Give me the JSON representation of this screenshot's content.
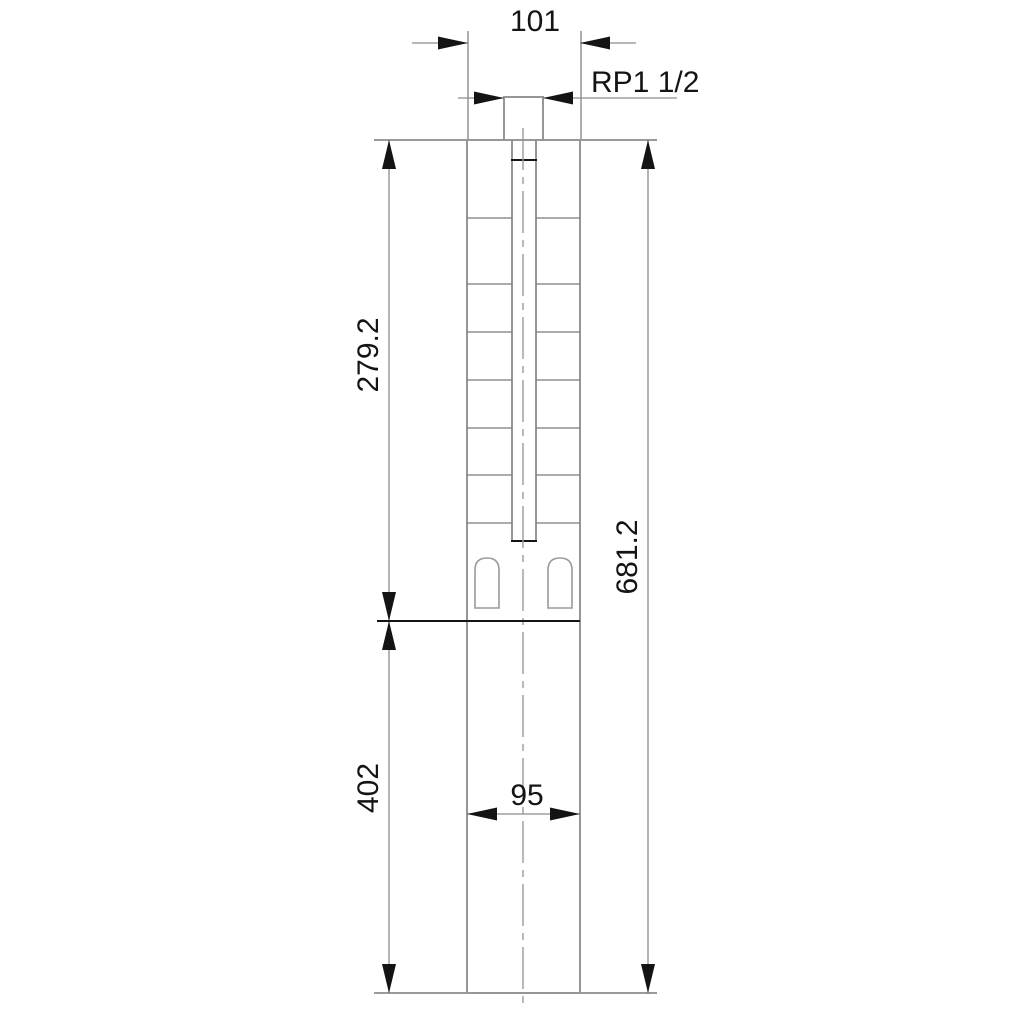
{
  "drawing": {
    "type": "engineering-dimension-drawing",
    "subject": "submersible pump outline, front view with overall dimensions",
    "colors": {
      "background": "#ffffff",
      "outline_gray": "#969696",
      "detail_gray": "#7a7a7a",
      "dimension_gray": "#8c8c8c",
      "ink_black": "#141414"
    },
    "labels": {
      "top_width": "101",
      "thread": "RP1 1/2",
      "pump_section_length": "279.2",
      "total_length": "681.2",
      "motor_section_length": "402",
      "motor_width": "95"
    }
  }
}
